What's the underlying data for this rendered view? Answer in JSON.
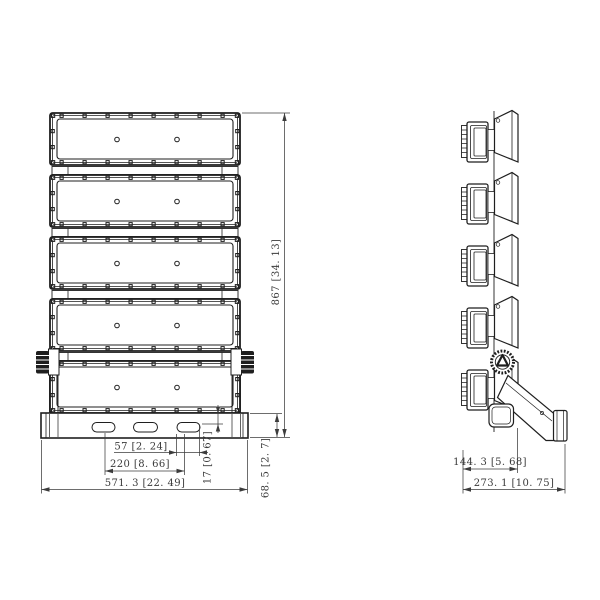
{
  "colors": {
    "background": "#ffffff",
    "line": "#1f1f1f",
    "dim_line": "#3c3c3c",
    "text": "#3a3a3a"
  },
  "front_view": {
    "module_count": 5,
    "mounting_slot_count": 3,
    "dims": {
      "slot_length": "57 [2. 24]",
      "slot_spacing": "220 [8. 66]",
      "overall_width": "571. 3 [22. 49]",
      "slot_vertical_offset": "17 [0. 67]",
      "bracket_height": "68. 5 [2. 7]",
      "overall_height": "867 [34. 13]"
    }
  },
  "side_view": {
    "module_count": 5,
    "dims": {
      "body_depth": "144. 3 [5. 68]",
      "overall_depth": "273. 1 [10. 75]"
    }
  }
}
